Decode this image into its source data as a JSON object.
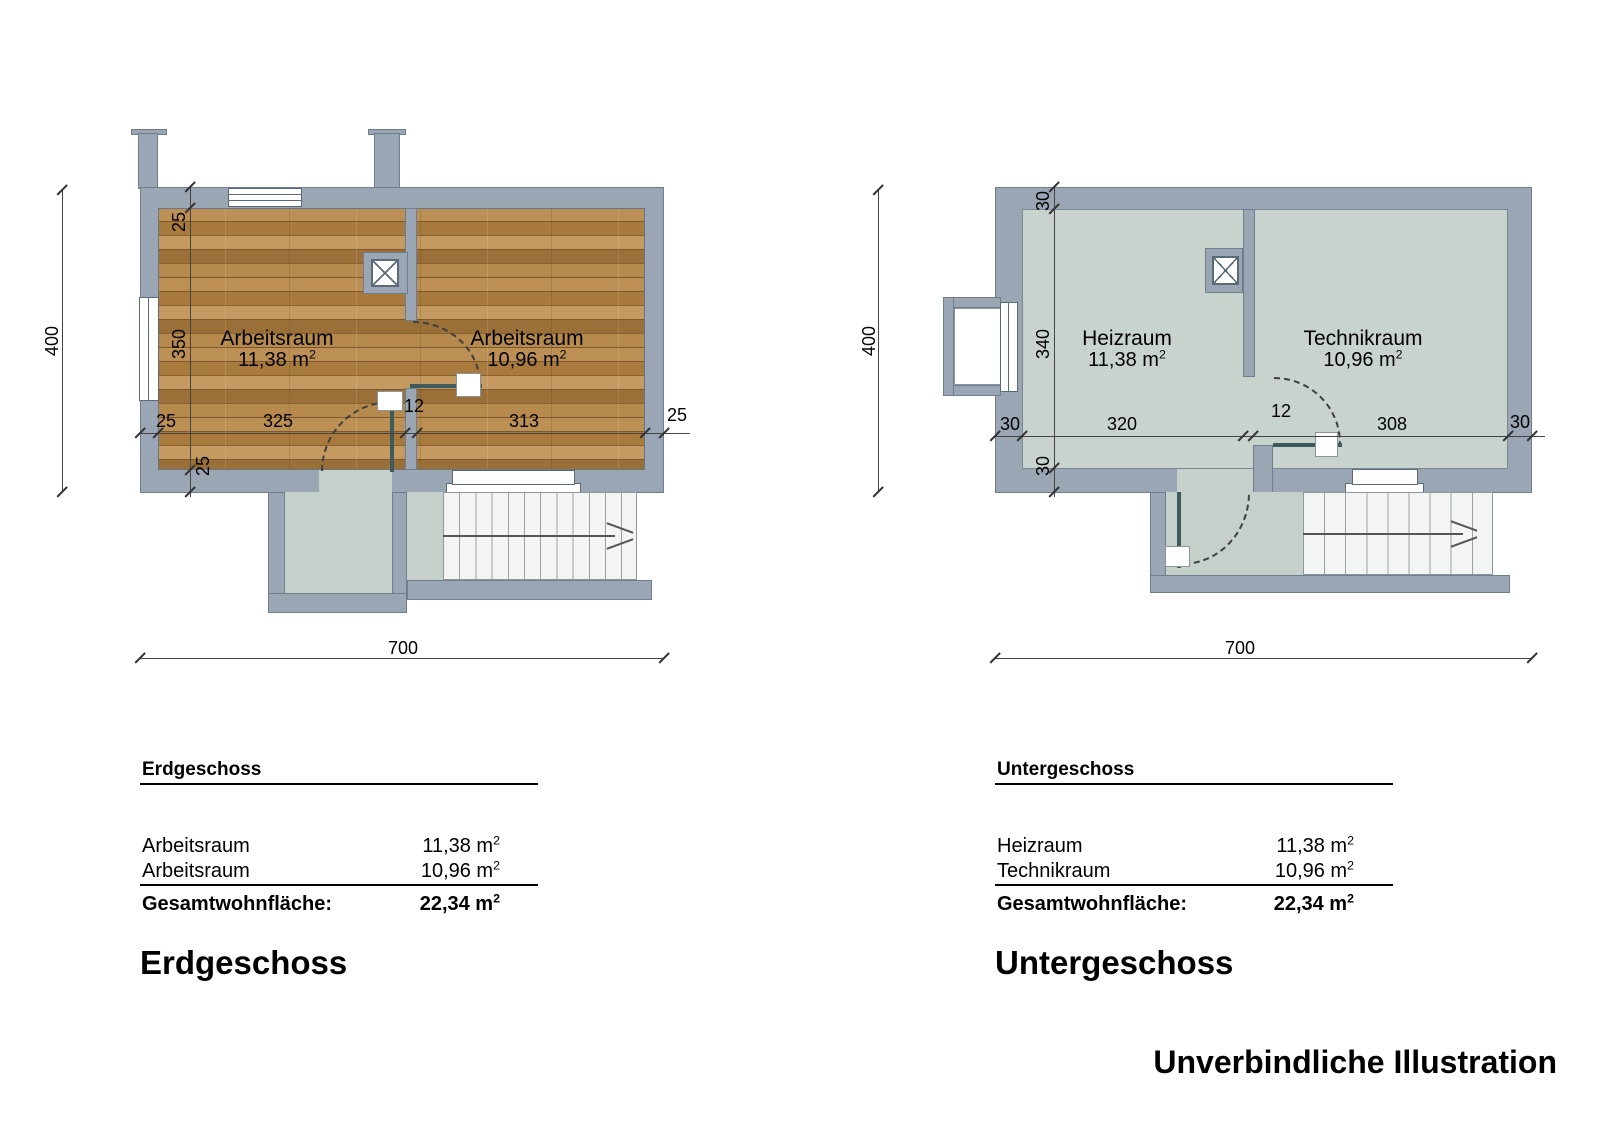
{
  "watermark": "Unverbindliche Illustration",
  "plans": [
    {
      "rooms": [
        {
          "name": "Arbeitsraum",
          "area": "11,38 m",
          "sup": "2"
        },
        {
          "name": "Arbeitsraum",
          "area": "10,96 m",
          "sup": "2"
        }
      ],
      "dims": {
        "total_height": "400",
        "total_width": "700",
        "wall_top": "25",
        "inner_height": "350",
        "wall_bottom_rot": "25",
        "wall_left": "25",
        "room1_width": "325",
        "partition": "12",
        "room2_width": "313",
        "wall_right": "25"
      },
      "table": {
        "header": "Erdgeschoss",
        "rows": [
          {
            "label": "Arbeitsraum",
            "value": "11,38 m",
            "sup": "2"
          },
          {
            "label": "Arbeitsraum",
            "value": "10,96 m",
            "sup": "2"
          }
        ],
        "total_label": "Gesamtwohnfläche:",
        "total_value": "22,34 m",
        "total_sup": "2"
      },
      "big_title": "Erdgeschoss"
    },
    {
      "rooms": [
        {
          "name": "Heizraum",
          "area": "11,38 m",
          "sup": "2"
        },
        {
          "name": "Technikraum",
          "area": "10,96 m",
          "sup": "2"
        }
      ],
      "dims": {
        "total_height": "400",
        "total_width": "700",
        "wall_top": "30",
        "inner_height": "340",
        "wall_bottom_rot": "30",
        "wall_left": "30",
        "room1_width": "320",
        "partition": "12",
        "room2_width": "308",
        "wall_right": "30"
      },
      "table": {
        "header": "Untergeschoss",
        "rows": [
          {
            "label": "Heizraum",
            "value": "11,38 m",
            "sup": "2"
          },
          {
            "label": "Technikraum",
            "value": "10,96 m",
            "sup": "2"
          }
        ],
        "total_label": "Gesamtwohnfläche:",
        "total_value": "22,34 m",
        "total_sup": "2"
      },
      "big_title": "Untergeschoss"
    }
  ]
}
